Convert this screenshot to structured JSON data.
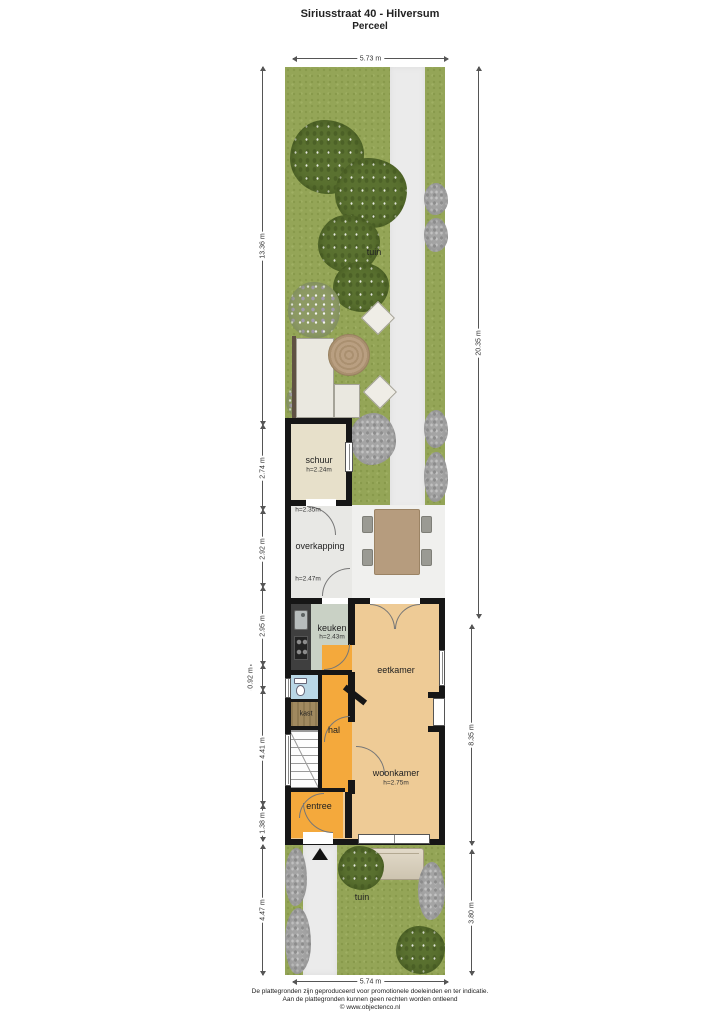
{
  "header": {
    "title": "Siriusstraat 40 - Hilversum",
    "subtitle": "Perceel"
  },
  "dimensions": {
    "top": "5.73 m",
    "bottom": "5.74 m",
    "left": [
      "13.36 m",
      "2.74 m",
      "2.92 m",
      "2.95 m",
      "0.92 m",
      "4.41 m",
      "1.38 m",
      "4.47 m"
    ],
    "right": [
      "20.35 m",
      "8.35 m",
      "3.80 m"
    ]
  },
  "rooms": {
    "tuin_back": {
      "name": "tuin"
    },
    "schuur": {
      "name": "schuur",
      "height": "h=2.24m"
    },
    "overkapping": {
      "name": "overkapping",
      "height_top": "h=2.35m",
      "height_bottom": "h=2.47m"
    },
    "keuken": {
      "name": "keuken",
      "height": "h=2.43m"
    },
    "eetkamer": {
      "name": "eetkamer"
    },
    "kast": {
      "name": "kast"
    },
    "hal": {
      "name": "hal"
    },
    "woonkamer": {
      "name": "woonkamer",
      "height": "h=2.75m"
    },
    "entree": {
      "name": "entree"
    },
    "tuin_front": {
      "name": "tuin"
    }
  },
  "footer": {
    "line1": "De plattegronden zijn geproduceerd voor promotionele doeleinden en ter indicatie.",
    "line2": "Aan de plattegronden kunnen geen rechten worden ontleend",
    "line3": "© www.objectenco.nl"
  },
  "colors": {
    "lawn": "#94a557",
    "tree": "#5a7130",
    "path": "#ebebeb",
    "wall": "#161616",
    "floor_wood": "#eecb96",
    "floor_hal": "#f4a93c",
    "floor_keuken": "#c9d1c5",
    "floor_schuur": "#e7e0ca",
    "floor_overkapping": "#e8e8e5",
    "floor_kast": "#a0895f",
    "floor_toilet": "#b9d7e6",
    "table_wood": "#b69c7e"
  }
}
